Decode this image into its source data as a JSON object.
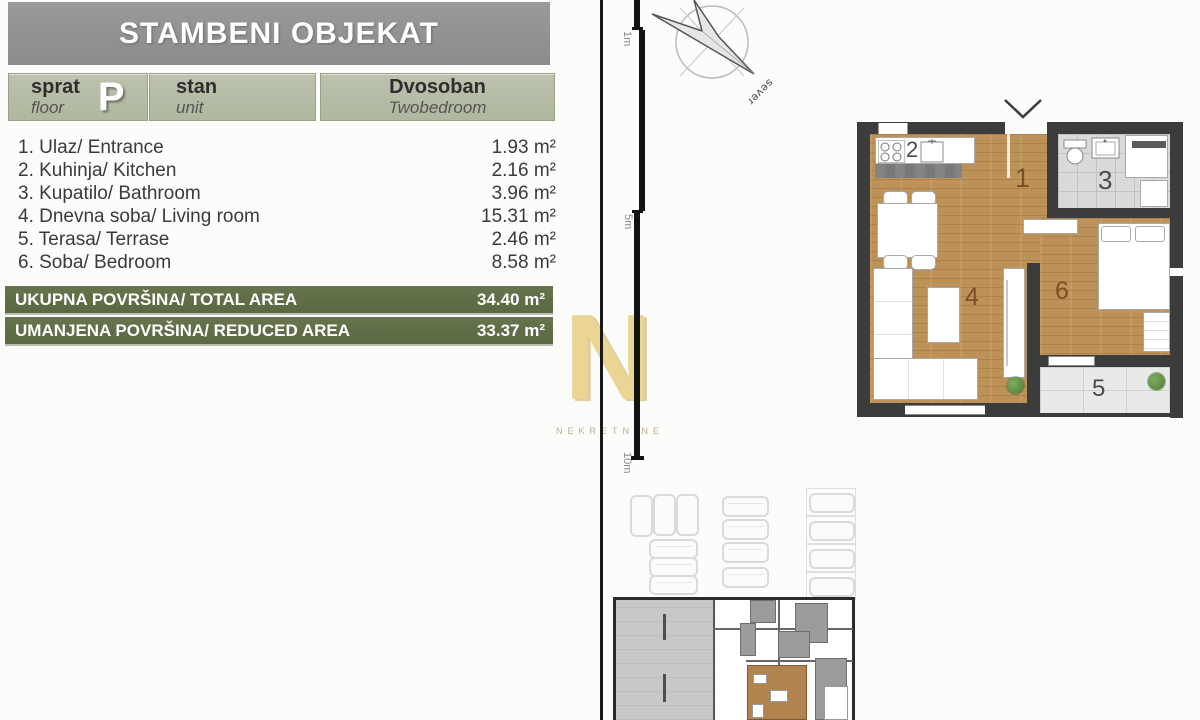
{
  "header": {
    "title": "STAMBENI OBJEKAT"
  },
  "info_cells": {
    "floor": {
      "label_sr": "sprat",
      "label_en": "floor",
      "value": "P"
    },
    "unit": {
      "label_sr": "stan",
      "label_en": "unit"
    },
    "type": {
      "label_sr": "Dvosoban",
      "label_en": "Twobedroom"
    }
  },
  "rooms": [
    {
      "label": "1. Ulaz/ Entrance",
      "area": "1.93 m²"
    },
    {
      "label": "2. Kuhinja/ Kitchen",
      "area": "2.16 m²"
    },
    {
      "label": "3. Kupatilo/ Bathroom",
      "area": "3.96 m²"
    },
    {
      "label": "4. Dnevna soba/ Living room",
      "area": "15.31 m²"
    },
    {
      "label": "5. Terasa/ Terrase",
      "area": "2.46 m²"
    },
    {
      "label": "6. Soba/ Bedroom",
      "area": "8.58 m²"
    }
  ],
  "totals": [
    {
      "label": "UKUPNA POVRŠINA/ TOTAL AREA",
      "value": "34.40 m²"
    },
    {
      "label": "UMANJENA POVRŠINA/ REDUCED AREA",
      "value": "33.37 m²"
    }
  ],
  "watermark": {
    "letter": "N",
    "text": "NEKRETNINE"
  },
  "scale": {
    "labels": [
      "1m",
      "5m",
      "10m"
    ]
  },
  "compass": {
    "label": "sever"
  },
  "plan": {
    "numbers": [
      "1",
      "2",
      "3",
      "4",
      "5",
      "6"
    ]
  },
  "colors": {
    "header_gray": "#909090",
    "cell_sage": "#b5bca6",
    "total_olive": "#5f6d49",
    "wall_dark": "#3c3c3c",
    "wood_floor": "#bd9258",
    "watermark_gold": "#ead592",
    "highlight_unit_tan": "#b1834f"
  }
}
